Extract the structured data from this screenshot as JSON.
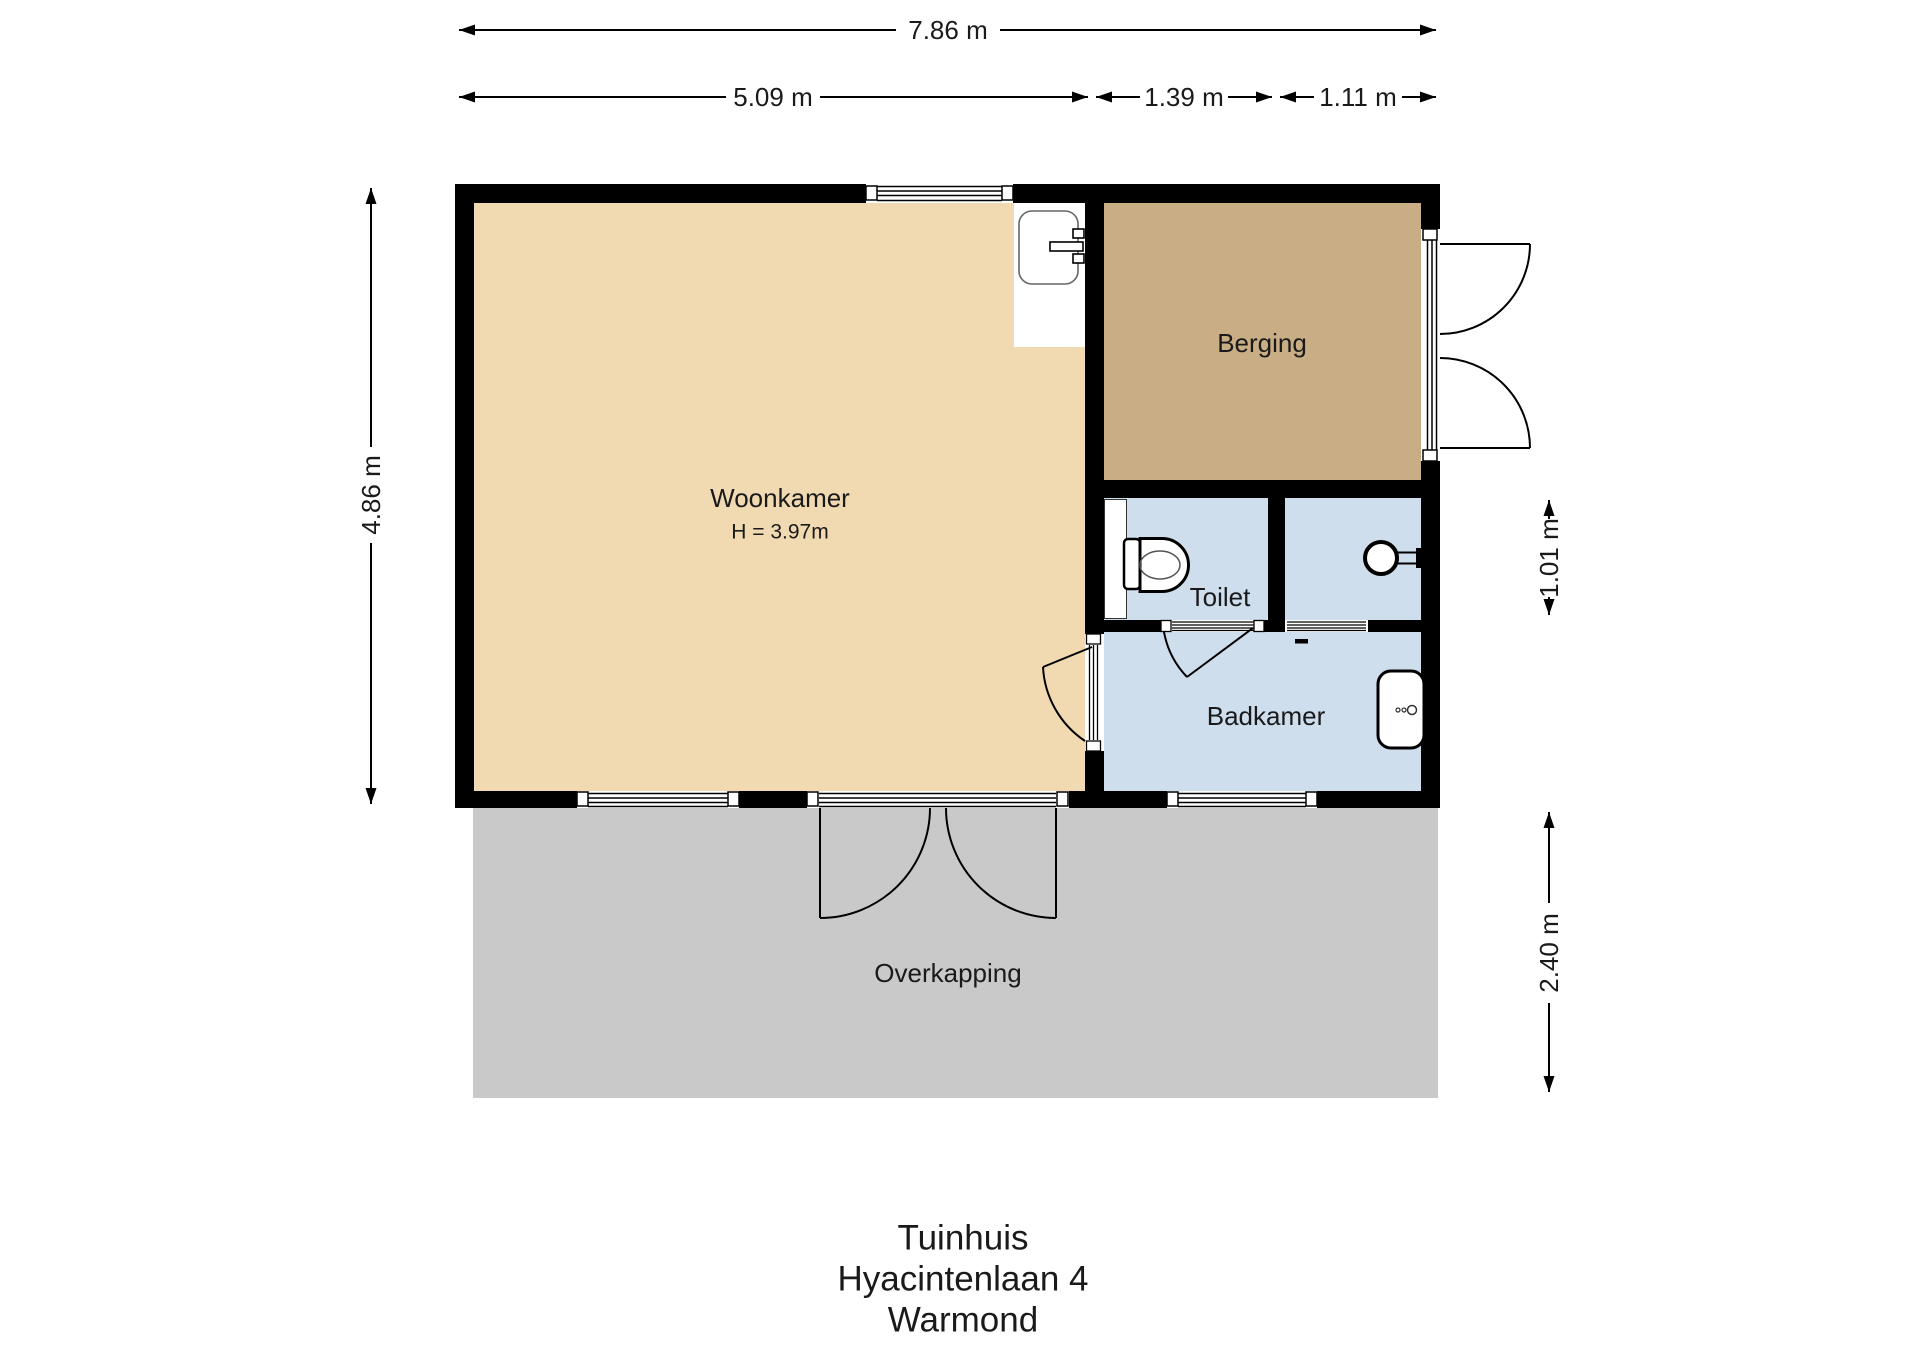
{
  "title": {
    "line1": "Tuinhuis",
    "line2": "Hyacintenlaan 4",
    "line3": "Warmond"
  },
  "dimensions": {
    "total_width": "7.86 m",
    "woonkamer_width": "5.09 m",
    "toilet_width": "1.39 m",
    "shower_width": "1.11 m",
    "total_height": "4.86 m",
    "toilet_row_height": "1.01 m",
    "overkapping_depth": "2.40 m"
  },
  "rooms": {
    "woonkamer": {
      "label": "Woonkamer",
      "height_note": "H = 3.97m",
      "color": "#f1dab2"
    },
    "berging": {
      "label": "Berging",
      "color": "#c9ad85"
    },
    "toilet": {
      "label": "Toilet",
      "color": "#cfdeed"
    },
    "shower": {
      "color": "#cfdeed"
    },
    "badkamer": {
      "label": "Badkamer",
      "color": "#cfdeed"
    },
    "overkapping": {
      "label": "Overkapping",
      "color": "#c9c9c9"
    }
  },
  "colors": {
    "wall": "#000000",
    "interior": "#ffffff",
    "dimension": "#000000"
  }
}
